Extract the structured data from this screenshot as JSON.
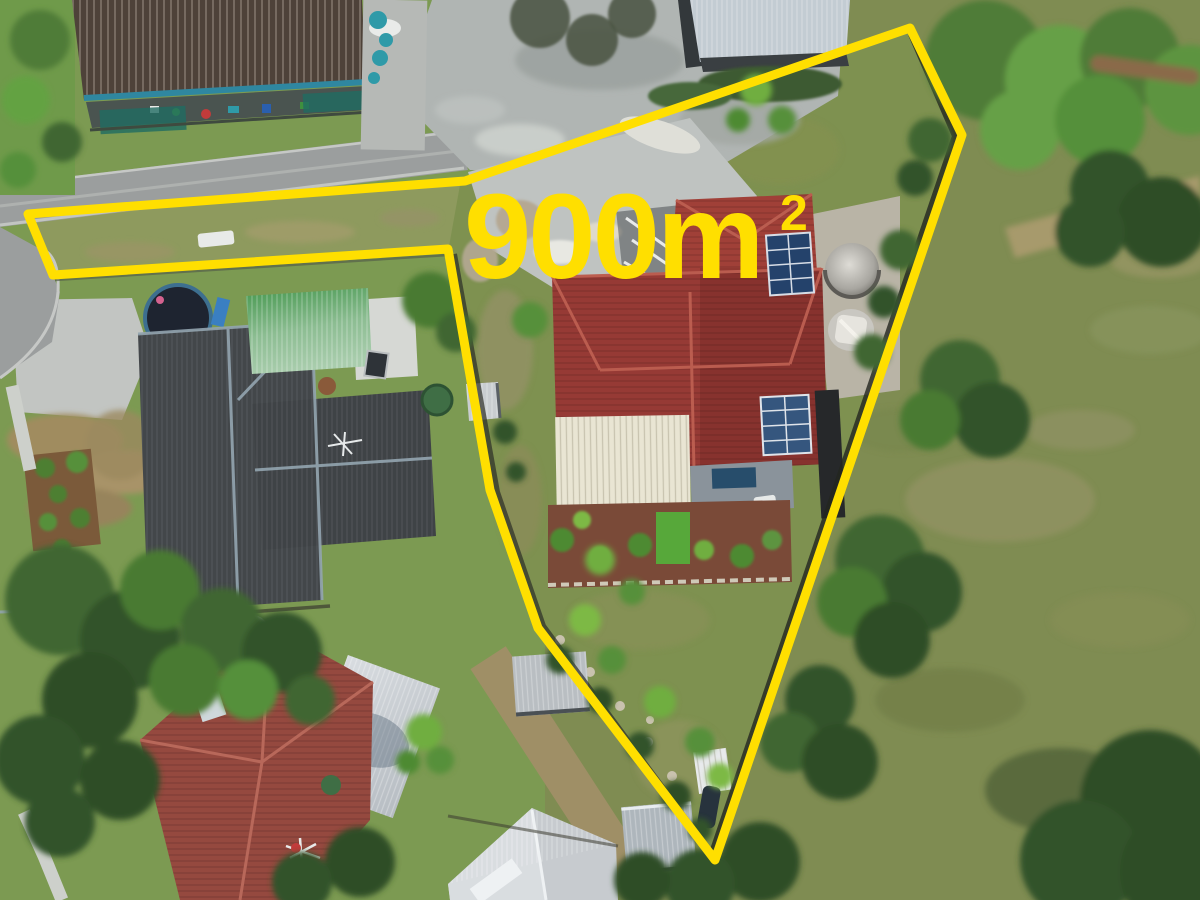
{
  "overlay": {
    "area_text": "900m",
    "area_superscript": "2"
  },
  "colors": {
    "boundary_line": "#FFDF00",
    "area_label": "#FFDF00",
    "subject_roof_red": "#963A35",
    "subject_roof_top": "#A04038",
    "cream_garage_roof": "#E9E5D3",
    "neighbor_roof_charcoal": "#43474A",
    "neighbor_roof_green": "#55A25E",
    "bottom_house_roof": "#95493F",
    "big_shed_roof": "#C3CCD3",
    "solar_panel_blue": "#24426B",
    "park_grass": "#7F8C52",
    "lawn_green": "#7C9A52",
    "road_gray": "#9B9E9E",
    "concrete_pad": "#B0B5B3",
    "dirt_tan": "#A08C5F",
    "tree_dark_green": "#33522A",
    "water_tank_gray": "#C9C7C1"
  }
}
